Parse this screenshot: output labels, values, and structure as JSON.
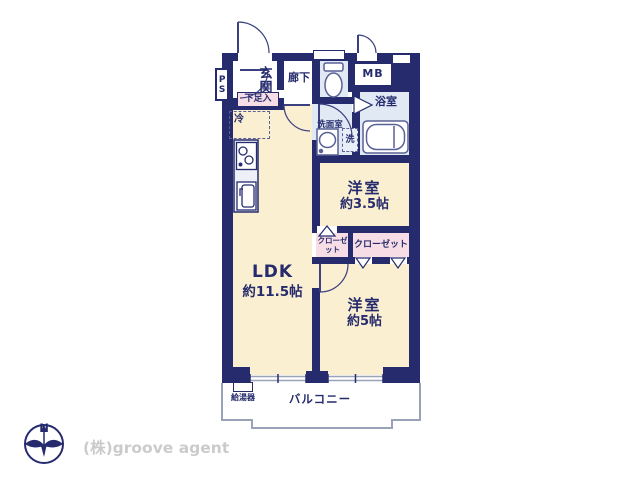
{
  "floorplan": {
    "labels": {
      "ps": "PS",
      "genkan": "玄関",
      "hallway": "廊下",
      "shoe_box": "下足入",
      "mb": "MB",
      "bathroom": "浴室",
      "washroom": "洗面室",
      "washer": "洗",
      "fridge": "冷",
      "room_35": "洋室",
      "room_35_size": "約3.5帖",
      "closet_small": "クローゼット",
      "closet_wide": "クローゼット",
      "ldk": "LDK",
      "ldk_size": "約11.5帖",
      "room_5": "洋室",
      "room_5_size": "約5帖",
      "water_heater": "給湯器",
      "balcony": "バルコニー"
    },
    "compass_north": "N",
    "company": "(株)groove agent",
    "colors": {
      "wall": "#252b6d",
      "floor_main": "#faefd0",
      "floor_wet": "#e0e9f4",
      "closet": "#f7dde6",
      "balcony_line": "#9aa2b8",
      "company_text": "#cbcbcb"
    }
  }
}
